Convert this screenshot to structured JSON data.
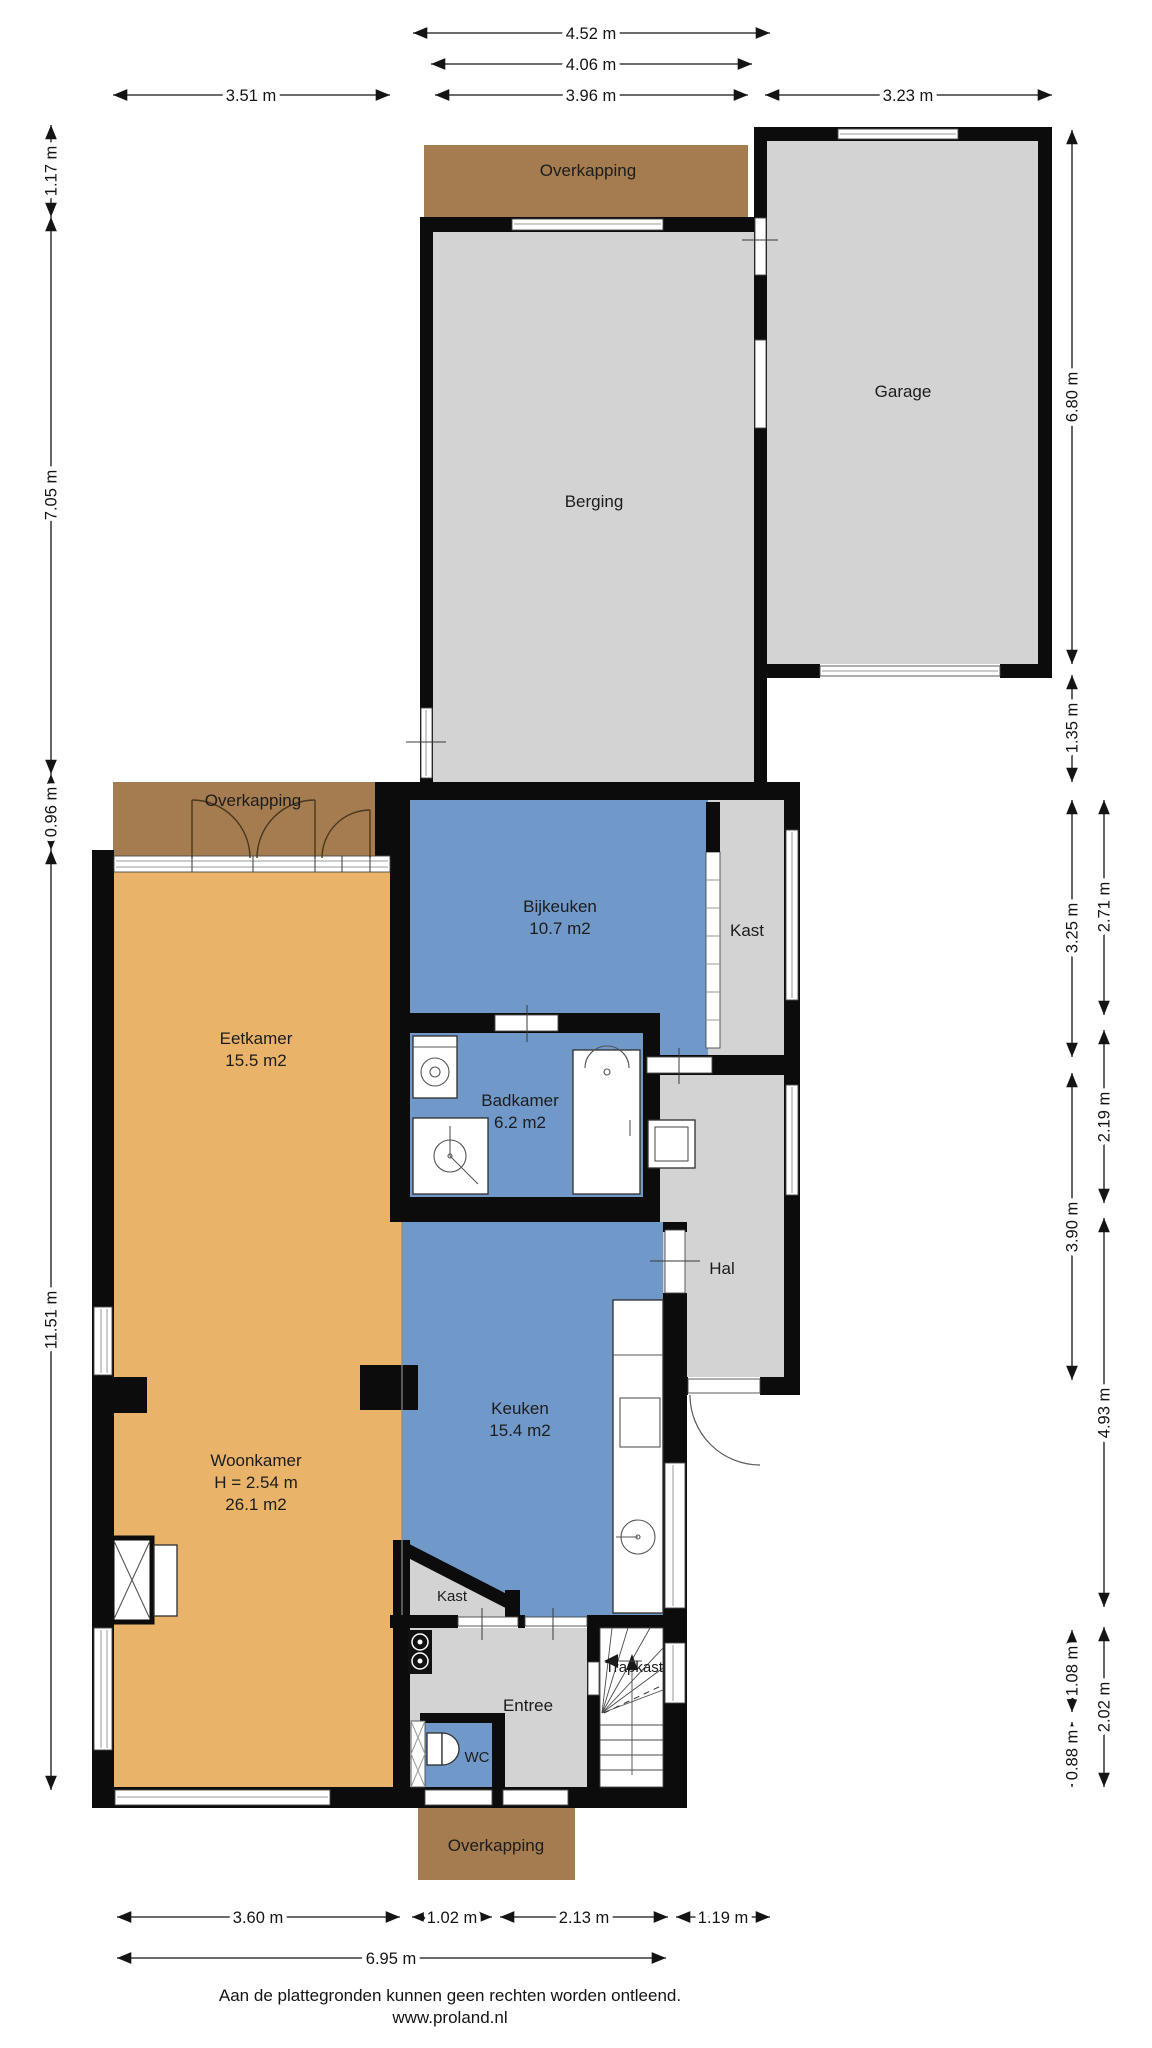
{
  "rooms": {
    "overkapping_top": {
      "label": "Overkapping"
    },
    "garage": {
      "label": "Garage"
    },
    "berging": {
      "label": "Berging"
    },
    "overkapping_left": {
      "label": "Overkapping"
    },
    "bijkeuken": {
      "label": "Bijkeuken",
      "area": "10.7 m2"
    },
    "kast_bijkeuken": {
      "label": "Kast"
    },
    "badkamer": {
      "label": "Badkamer",
      "area": "6.2 m2"
    },
    "hal": {
      "label": "Hal"
    },
    "eetkamer": {
      "label": "Eetkamer",
      "area": "15.5 m2"
    },
    "keuken": {
      "label": "Keuken",
      "area": "15.4 m2"
    },
    "woonkamer": {
      "label": "Woonkamer",
      "ceiling_height": "H = 2.54 m",
      "area": "26.1 m2"
    },
    "kast_keuken": {
      "label": "Kast"
    },
    "trapkast": {
      "label": "Trapkast"
    },
    "entree": {
      "label": "Entree"
    },
    "wc": {
      "label": "WC"
    },
    "overkapping_bottom": {
      "label": "Overkapping"
    }
  },
  "dims": {
    "top_452": "4.52 m",
    "top_406": "4.06 m",
    "top_351": "3.51 m",
    "top_396": "3.96 m",
    "top_323": "3.23 m",
    "left_117": "1.17 m",
    "left_705": "7.05 m",
    "left_096": "0.96 m",
    "left_1151": "11.51 m",
    "right_680": "6.80 m",
    "right_135": "1.35 m",
    "right_325": "3.25 m",
    "right_390": "3.90 m",
    "right_108": "1.08 m",
    "right_088": "0.88 m",
    "right_271": "2.71 m",
    "right_219": "2.19 m",
    "right_493": "4.93 m",
    "right_202": "2.02 m",
    "bottom_360": "3.60 m",
    "bottom_102": "1.02 m",
    "bottom_213": "2.13 m",
    "bottom_119": "1.19 m",
    "bottom_695": "6.95 m"
  },
  "footer": {
    "disclaimer": "Aan de plattegronden kunnen geen rechten worden ontleend.",
    "website": "www.proland.nl"
  },
  "colors": {
    "wall": "#0c0c0c",
    "floor_gray": "#d3d3d3",
    "floor_blue": "#7099ca",
    "floor_orange": "#e9b469",
    "overkapping_brown": "#a47c4f",
    "stair_white": "#ffffff",
    "dim_text": "#141414"
  }
}
